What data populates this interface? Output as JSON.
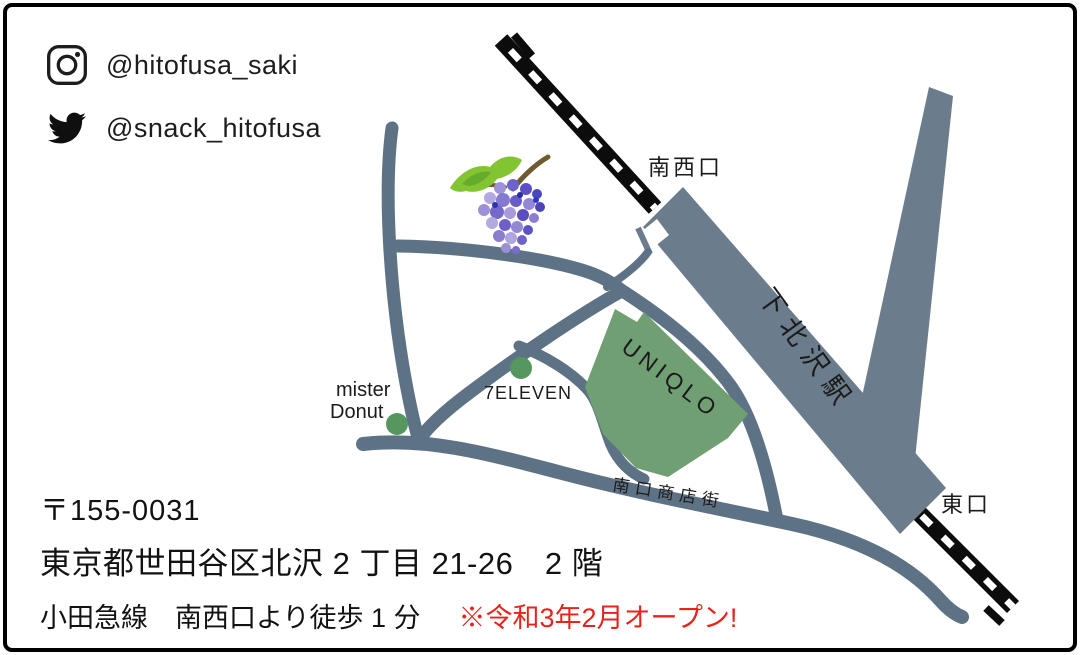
{
  "social": {
    "instagram": {
      "icon": "instagram-icon",
      "handle": "@hitofusa_saki"
    },
    "twitter": {
      "icon": "twitter-icon",
      "handle": "@snack_hitofusa"
    }
  },
  "map": {
    "station_name": "下北沢駅",
    "exits": {
      "southwest": "南西口",
      "east": "東口"
    },
    "street_label": "南口商店街",
    "landmarks": {
      "uniqlo": "UNIQLO",
      "seven_eleven": "7ELEVEN",
      "mister_donut_line1": "mister",
      "mister_donut_line2": "Donut"
    }
  },
  "address": {
    "postal_code": "〒155-0031",
    "street": "東京都世田谷区北沢 2 丁目 21-26　2 階",
    "access": "小田急線　南西口より徒歩 1 分",
    "notice": "※令和3年2月オープン!"
  },
  "colors": {
    "road": "#5e7285",
    "station": "#6b7d8c",
    "building_green": "#6f9f72",
    "marker_green": "#55975e",
    "railway": "#0c0c0c",
    "notice_red": "#e8231c"
  }
}
